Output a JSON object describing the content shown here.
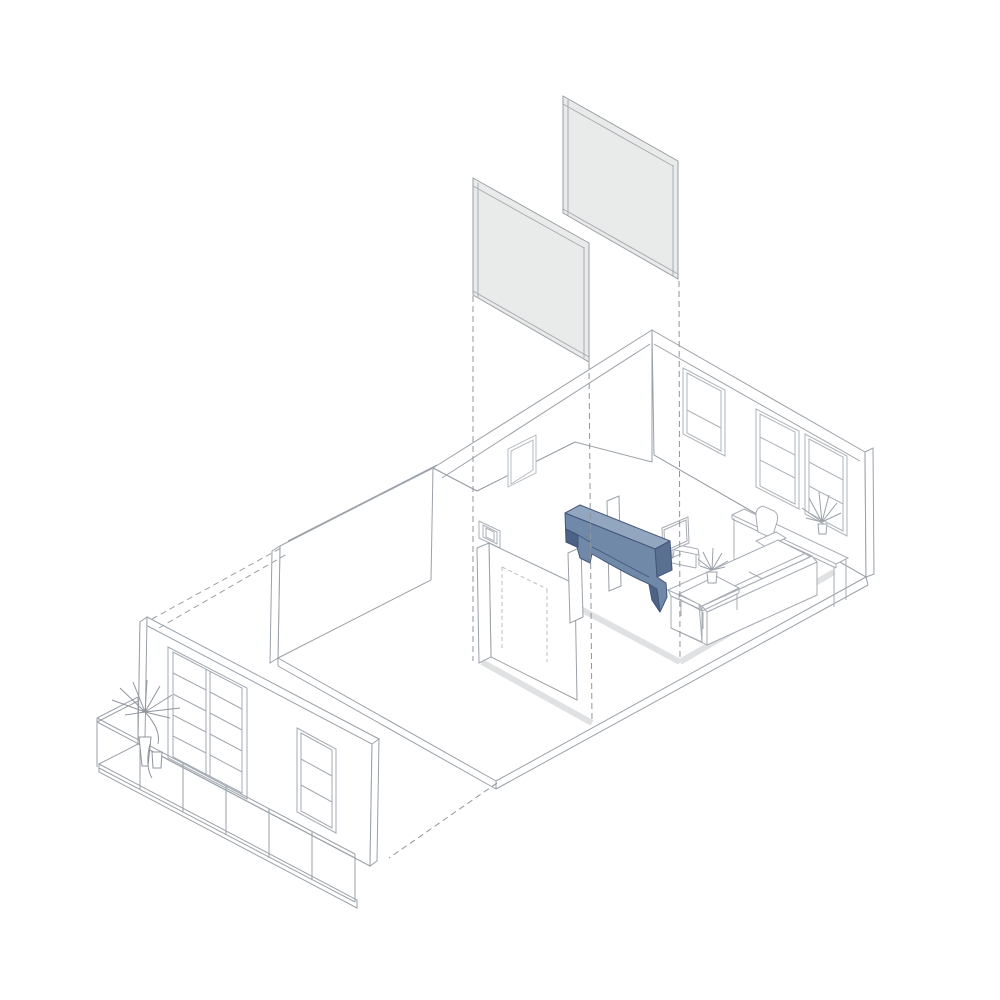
{
  "drawing": {
    "kind": "exploded-axonometric-apartment-renovation-diagram",
    "background": "#ffffff",
    "exploded_panels": {
      "count": 2,
      "meaning": "removed-wall-panels"
    },
    "projection_lines": {
      "count": 3,
      "style": "dashed-vertical"
    },
    "floor_tracks": {
      "count": 3,
      "meaning": "former-wall-footprints"
    },
    "highlight_element": "arched-beam-with-corbels",
    "rooms": [
      "balcony",
      "left-room",
      "hallway",
      "living-room"
    ],
    "furniture": [
      "tv",
      "media-console",
      "coffee-table",
      "potted-plant",
      "sofa",
      "desk",
      "desk-plant",
      "office-chair",
      "balcony-plant"
    ],
    "openings": [
      "french-door",
      "facade-window",
      "small-back-window",
      "living-window-left",
      "living-window-right",
      "hallway-door-frame",
      "dashed-hidden-door"
    ]
  },
  "colors": {
    "line": "#9aa1a8",
    "line_light": "#b6bcc2",
    "line_faint": "#c6cbd0",
    "panel_fill": "#e9eaea",
    "panel_edge": "#dfe0e0",
    "panel_stroke": "#9a9fa4",
    "track": "#e0e1e2",
    "dash": "#8f959c",
    "white": "#ffffff",
    "arch_front": "#7189a8",
    "arch_top": "#92a6c0",
    "arch_side": "#5a7090",
    "arch_dark": "#4d6385",
    "arch_stroke": "#43567a"
  }
}
